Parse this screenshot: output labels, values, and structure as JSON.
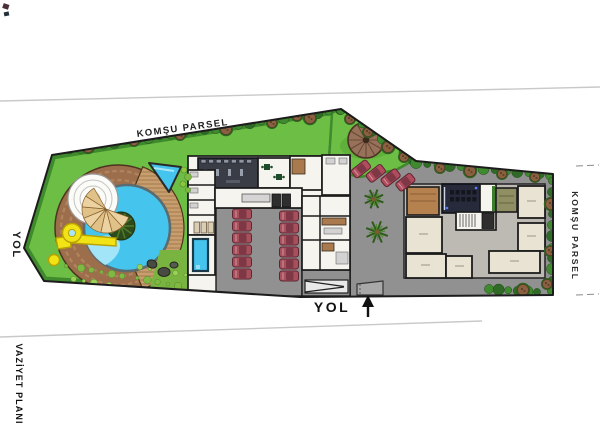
{
  "labels": {
    "komsu_parsel_top": "KOMŞU PARSEL",
    "komsu_parsel_right": "KOMŞU PARSEL",
    "yol_left": "YOL",
    "yol_bottom": "YOL",
    "vaziyet_plani": "VAZİYET PLANI",
    "north_arrow": "↑"
  },
  "parking": {
    "garage_columns": [
      6,
      6
    ],
    "surface_cars": 4
  },
  "palette": {
    "grass": "#6cbe44",
    "grass_dark": "#3f8a2c",
    "pavement": "#919191",
    "terrace": "#bdbab3",
    "pool_water": "#45c4ee",
    "pool_shallow": "#a9e7f8",
    "deck_brick": "#9c6e4c",
    "deck_wood": "#c79e6d",
    "room_white": "#f6f4ee",
    "room_beige": "#e8e3d3",
    "room_brown": "#b5824f",
    "room_olive": "#8f8f63",
    "gym_dark": "#3a3d46",
    "cinema_dark": "#262a3a",
    "car_red": "#a84f5c",
    "slide_yellow": "#f2e316",
    "bush_green": "#3f7d2e",
    "tree_brown": "#8a6040",
    "outline": "#1c1c1c"
  }
}
